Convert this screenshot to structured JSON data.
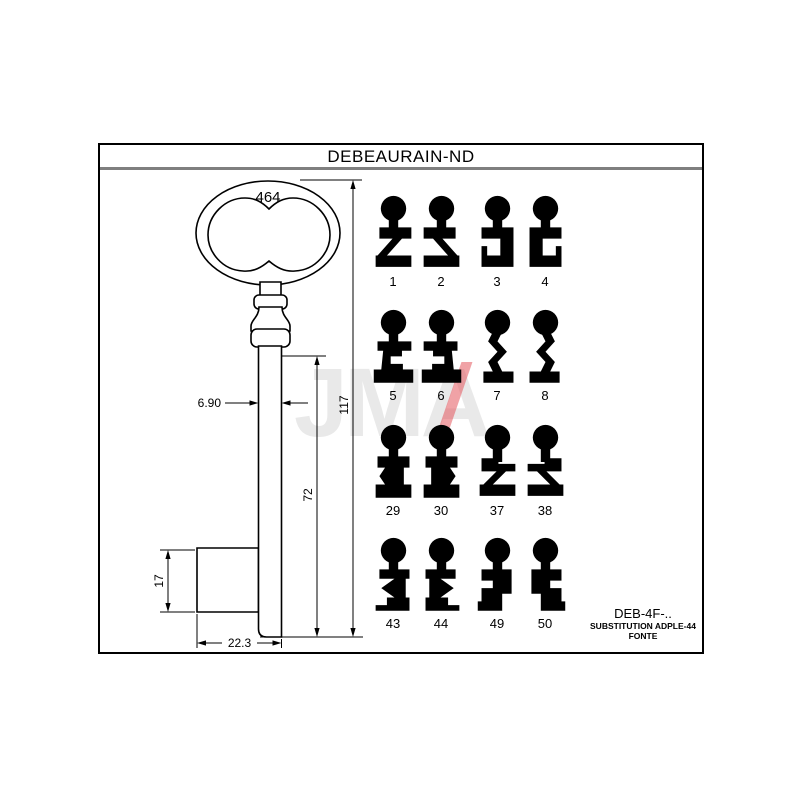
{
  "title": "DEBEAURAIN-ND",
  "watermark": {
    "text": "JMA",
    "gray_color": "#e9e9e9",
    "red_color": "#e4555c"
  },
  "drawing": {
    "dims": {
      "bow_ref": "464",
      "total_length": "117",
      "blade_length": "72",
      "shaft_width": "6.90",
      "bit_height": "17",
      "bit_width": "22.3"
    }
  },
  "profiles": [
    {
      "label": "1",
      "shape": "z-foot",
      "mirrored": false
    },
    {
      "label": "2",
      "shape": "z-foot",
      "mirrored": true
    },
    {
      "label": "3",
      "shape": "bracket",
      "mirrored": false
    },
    {
      "label": "4",
      "shape": "bracket",
      "mirrored": true
    },
    {
      "label": "5",
      "shape": "notched-trapezoid",
      "mirrored": false
    },
    {
      "label": "6",
      "shape": "notched-trapezoid",
      "mirrored": true
    },
    {
      "label": "7",
      "shape": "wave",
      "mirrored": false
    },
    {
      "label": "8",
      "shape": "wave",
      "mirrored": true
    },
    {
      "label": "29",
      "shape": "sigma",
      "mirrored": true
    },
    {
      "label": "30",
      "shape": "sigma",
      "mirrored": false
    },
    {
      "label": "37",
      "shape": "z-step",
      "mirrored": false
    },
    {
      "label": "38",
      "shape": "z-step",
      "mirrored": true
    },
    {
      "label": "43",
      "shape": "sigma-notched-foot",
      "mirrored": false
    },
    {
      "label": "44",
      "shape": "sigma-notched-foot",
      "mirrored": true
    },
    {
      "label": "49",
      "shape": "blocky-s",
      "mirrored": false
    },
    {
      "label": "50",
      "shape": "blocky-s",
      "mirrored": true
    }
  ],
  "footer": {
    "ref": "DEB-4F-..",
    "line2": "SUBSTITUTION ADPLE-44",
    "line3": "FONTE"
  }
}
